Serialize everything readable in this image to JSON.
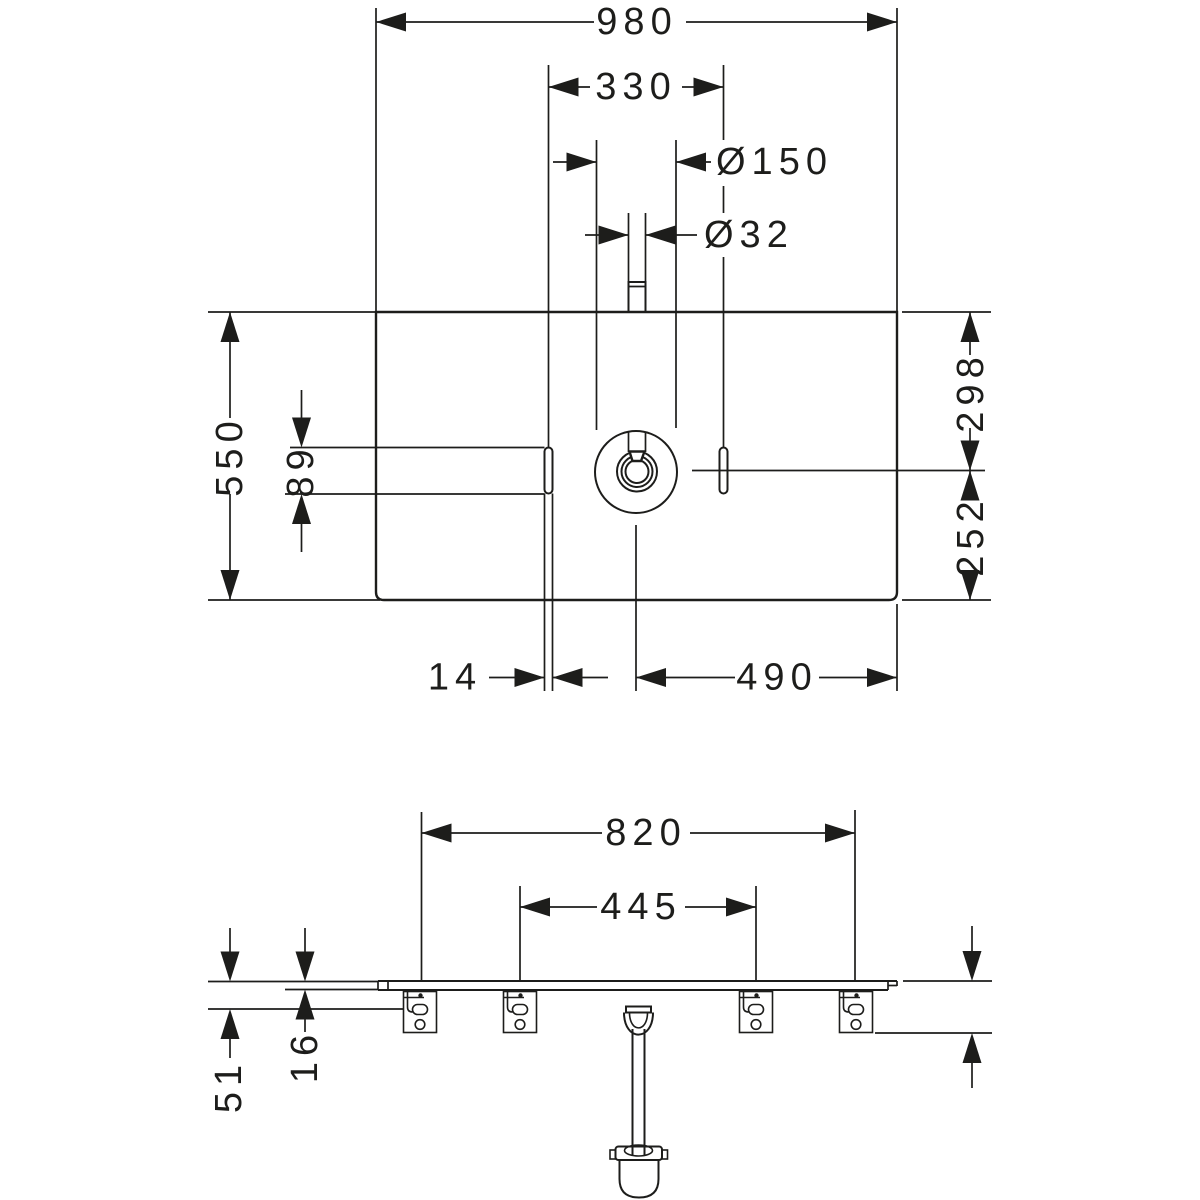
{
  "page": {
    "background": "#ffffff",
    "line_color": "#1d1d1b",
    "type": "sanitary-ware installation dimension drawing"
  },
  "views": {
    "top": {
      "label": "plan view",
      "dims": {
        "overall_width": "980",
        "tap_centres": "330",
        "mixer_base_dia": "Ø150",
        "tap_hole_dia": "Ø32",
        "overall_depth": "550",
        "slot_length": "89",
        "rear_to_axis": "298",
        "axis_to_front": "252",
        "slot_width": "14",
        "drain_to_edge": "490"
      }
    },
    "front": {
      "label": "front elevation",
      "dims": {
        "bracket_centres_outer": "820",
        "bracket_centres_inner": "445",
        "top_to_bracket_slot": "51",
        "panel_thickness": "16",
        "top_to_bracket_bottom": "96"
      }
    }
  }
}
